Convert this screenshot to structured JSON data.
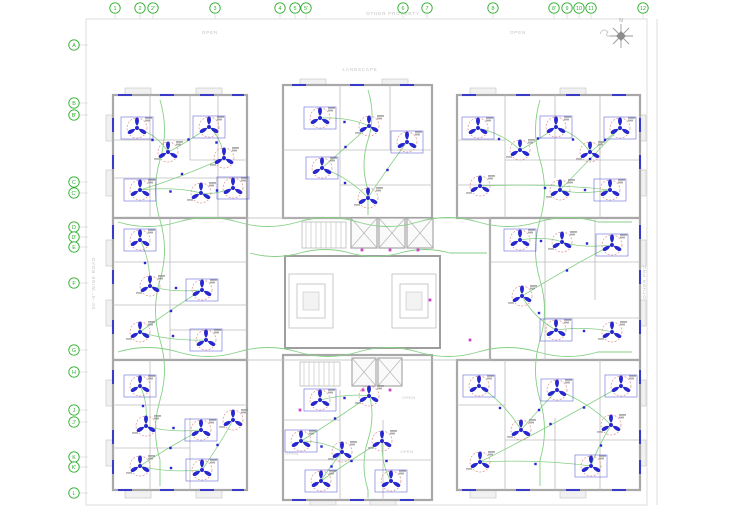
{
  "site": {
    "other_property_top": "OTHER PROPERTY",
    "other_property_right": "OTHER PROPERTY",
    "road_label": "50'-0\" WIDE ROAD",
    "landscape_top": "LANDSCAPE",
    "landscape_right": "LANDSCAPE",
    "open_left": "OPEN",
    "open_right": "OPEN",
    "open_court": "OPEN",
    "north_label": "N"
  },
  "grid": {
    "top": [
      {
        "label": "1",
        "x": 115
      },
      {
        "label": "2",
        "x": 140
      },
      {
        "label": "2'",
        "x": 153
      },
      {
        "label": "3",
        "x": 215
      },
      {
        "label": "4",
        "x": 280
      },
      {
        "label": "5",
        "x": 295
      },
      {
        "label": "5'",
        "x": 306
      },
      {
        "label": "6",
        "x": 403
      },
      {
        "label": "7",
        "x": 427
      },
      {
        "label": "8",
        "x": 493
      },
      {
        "label": "8'",
        "x": 554
      },
      {
        "label": "9",
        "x": 567
      },
      {
        "label": "10",
        "x": 579
      },
      {
        "label": "11",
        "x": 591
      },
      {
        "label": "12",
        "x": 643
      }
    ],
    "left": [
      {
        "label": "A",
        "y": 45
      },
      {
        "label": "B",
        "y": 103
      },
      {
        "label": "B'",
        "y": 115
      },
      {
        "label": "C",
        "y": 182
      },
      {
        "label": "C'",
        "y": 193
      },
      {
        "label": "D",
        "y": 227
      },
      {
        "label": "D'",
        "y": 237
      },
      {
        "label": "E",
        "y": 247
      },
      {
        "label": "F",
        "y": 283
      },
      {
        "label": "G",
        "y": 350
      },
      {
        "label": "H",
        "y": 372
      },
      {
        "label": "J",
        "y": 410
      },
      {
        "label": "J'",
        "y": 422
      },
      {
        "label": "K",
        "y": 457
      },
      {
        "label": "K'",
        "y": 467
      },
      {
        "label": "L",
        "y": 493
      }
    ]
  },
  "plan": {
    "colors": {
      "grid_green": "#2fae2f",
      "wiring_green": "#85cf85",
      "fixture_blue": "#2727cf",
      "fan_halo": "#dd8f8f",
      "wall_gray": "#a8a8a8",
      "label_gray": "#c2c2c2",
      "accent_magenta": "#cc44cc",
      "micro_text": "#8a8a8a"
    },
    "wings": {
      "tl": [
        [
          137,
          128
        ],
        [
          168,
          152
        ],
        [
          209,
          127
        ],
        [
          224,
          158
        ],
        [
          140,
          190
        ],
        [
          201,
          193
        ],
        [
          233,
          188
        ]
      ],
      "tc": [
        [
          320,
          118
        ],
        [
          369,
          126
        ],
        [
          322,
          168
        ],
        [
          368,
          198
        ],
        [
          407,
          142
        ]
      ],
      "tr": [
        [
          478,
          128
        ],
        [
          520,
          150
        ],
        [
          556,
          127
        ],
        [
          590,
          152
        ],
        [
          620,
          128
        ],
        [
          560,
          190
        ],
        [
          610,
          190
        ],
        [
          480,
          186
        ]
      ],
      "ml": [
        [
          140,
          240
        ],
        [
          150,
          286
        ],
        [
          202,
          290
        ],
        [
          140,
          332
        ],
        [
          206,
          340
        ]
      ],
      "mr": [
        [
          520,
          240
        ],
        [
          562,
          242
        ],
        [
          612,
          245
        ],
        [
          522,
          296
        ],
        [
          556,
          330
        ],
        [
          612,
          332
        ]
      ],
      "bl": [
        [
          140,
          386
        ],
        [
          146,
          426
        ],
        [
          201,
          430
        ],
        [
          140,
          466
        ],
        [
          202,
          470
        ],
        [
          233,
          420
        ]
      ],
      "bc": [
        [
          320,
          400
        ],
        [
          369,
          396
        ],
        [
          301,
          441
        ],
        [
          342,
          452
        ],
        [
          321,
          481
        ],
        [
          382,
          441
        ],
        [
          391,
          481
        ]
      ],
      "br": [
        [
          479,
          386
        ],
        [
          521,
          430
        ],
        [
          557,
          390
        ],
        [
          611,
          425
        ],
        [
          591,
          466
        ],
        [
          480,
          462
        ],
        [
          621,
          386
        ]
      ]
    },
    "open_shafts": [
      {
        "label": "OPEN",
        "x": 409,
        "y": 399
      },
      {
        "label": "OPEN",
        "x": 407,
        "y": 453
      },
      {
        "label": "OPEN",
        "x": 292,
        "y": 455
      }
    ]
  }
}
